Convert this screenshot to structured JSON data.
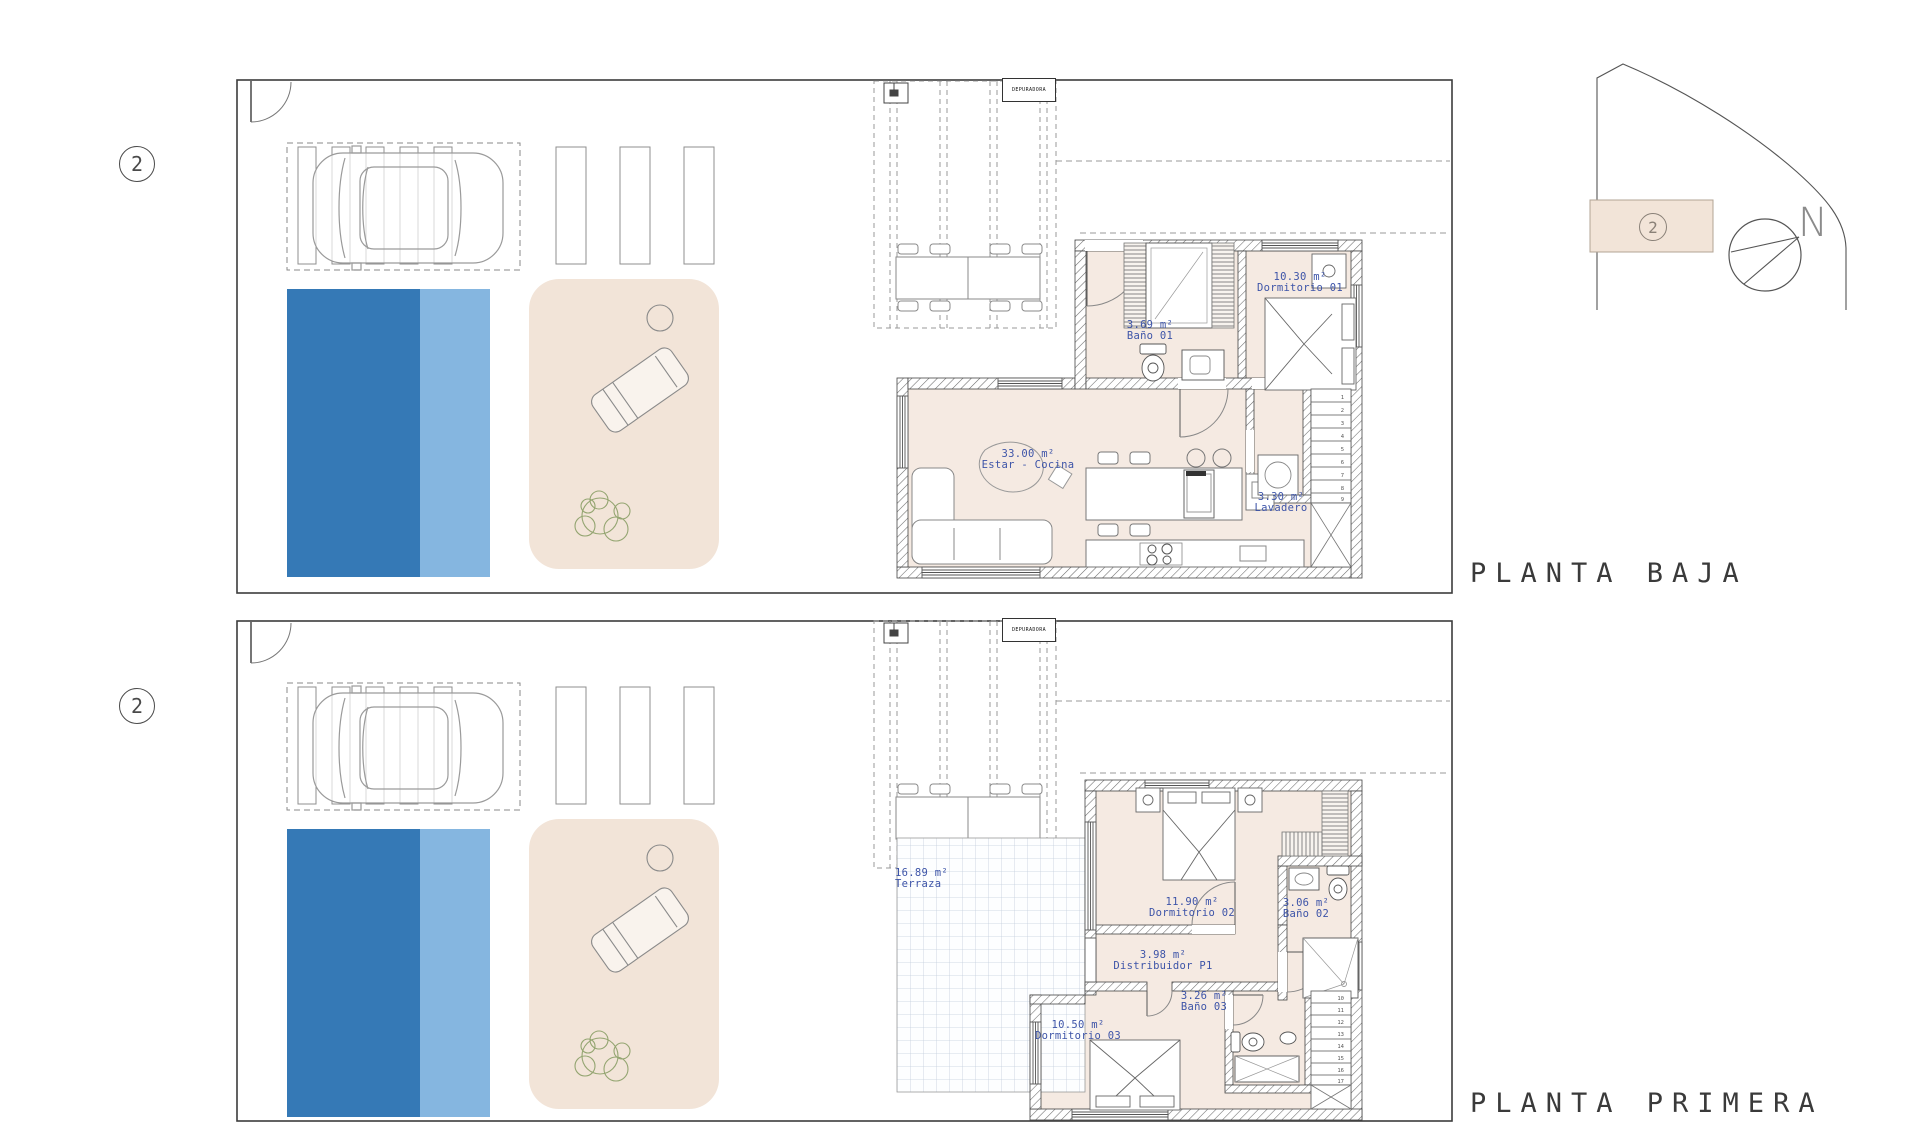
{
  "site_plan": {
    "unit_number": "2",
    "north_label": "N"
  },
  "plans": [
    {
      "title": "PLANTA BAJA",
      "unit_number": "2",
      "equipment_label": "DEPURADORA",
      "rooms": [
        {
          "area": "3.69 m²",
          "name": "Baño 01"
        },
        {
          "area": "10.30 m²",
          "name": "Dormitorio 01"
        },
        {
          "area": "33.00 m²",
          "name": "Estar - Cocina"
        },
        {
          "area": "3.30 m²",
          "name": "Lavadero"
        }
      ],
      "stair_steps": [
        "1",
        "2",
        "3",
        "4",
        "5",
        "6",
        "7",
        "8",
        "9"
      ]
    },
    {
      "title": "PLANTA PRIMERA",
      "unit_number": "2",
      "equipment_label": "DEPURADORA",
      "rooms": [
        {
          "area": "16.89 m²",
          "name": "Terraza"
        },
        {
          "area": "11.90 m²",
          "name": "Dormitorio 02"
        },
        {
          "area": "3.06 m²",
          "name": "Baño 02"
        },
        {
          "area": "3.98 m²",
          "name": "Distribuidor P1"
        },
        {
          "area": "10.50 m²",
          "name": "Dormitorio 03"
        },
        {
          "area": "3.26 m²",
          "name": "Baño 03"
        }
      ],
      "stair_steps": [
        "10",
        "11",
        "12",
        "13",
        "14",
        "15",
        "16",
        "17"
      ]
    }
  ],
  "colors": {
    "pool_dark": "#3579b6",
    "pool_light": "#85b6e0",
    "terrace": "#f2e4d8",
    "floor": "#f5eae2",
    "label_blue": "#3d54a8",
    "line_dark": "#3c3c3c",
    "plant_green": "#94a571",
    "tile_line": "#c3cedd"
  }
}
